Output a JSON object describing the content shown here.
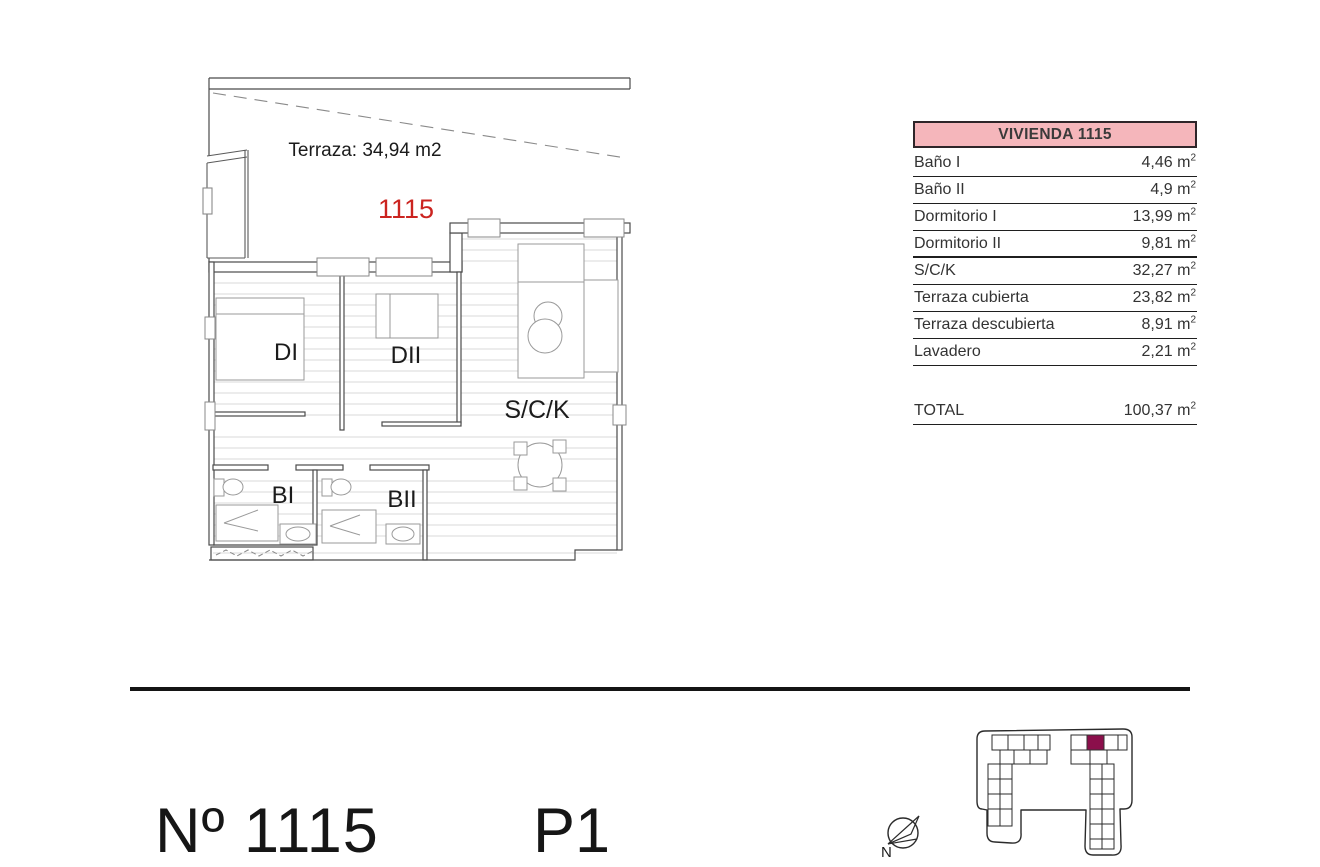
{
  "floor_plan": {
    "terrace_label": "Terraza: 34,94 m2",
    "unit_number": "1115",
    "rooms": {
      "bedroom1": "DI",
      "bedroom2": "DII",
      "living": "S/C/K",
      "bath1": "BI",
      "bath2": "BII"
    }
  },
  "area_table": {
    "title": "VIVIENDA 1115",
    "unit": "m",
    "unit_sup": "2",
    "rows": [
      {
        "label": "Baño I",
        "value": "4,46"
      },
      {
        "label": "Baño II",
        "value": "4,9"
      },
      {
        "label": "Dormitorio I",
        "value": "13,99"
      },
      {
        "label": "Dormitorio II",
        "value": "9,81"
      },
      {
        "label": "S/C/K",
        "value": "32,27"
      },
      {
        "label": "Terraza cubierta",
        "value": "23,82"
      },
      {
        "label": "Terraza descubierta",
        "value": "8,91"
      },
      {
        "label": "Lavadero",
        "value": "2,21"
      }
    ],
    "total": {
      "label": "TOTAL",
      "value": "100,37"
    }
  },
  "footer": {
    "unit_label": "Nº 1115",
    "floor_label": "P1"
  },
  "site_plan": {
    "north_label": "N"
  },
  "colors": {
    "header_pink": "#F5B6BB",
    "unit_red": "#CB2420",
    "site_highlight": "#8B0F4B"
  }
}
